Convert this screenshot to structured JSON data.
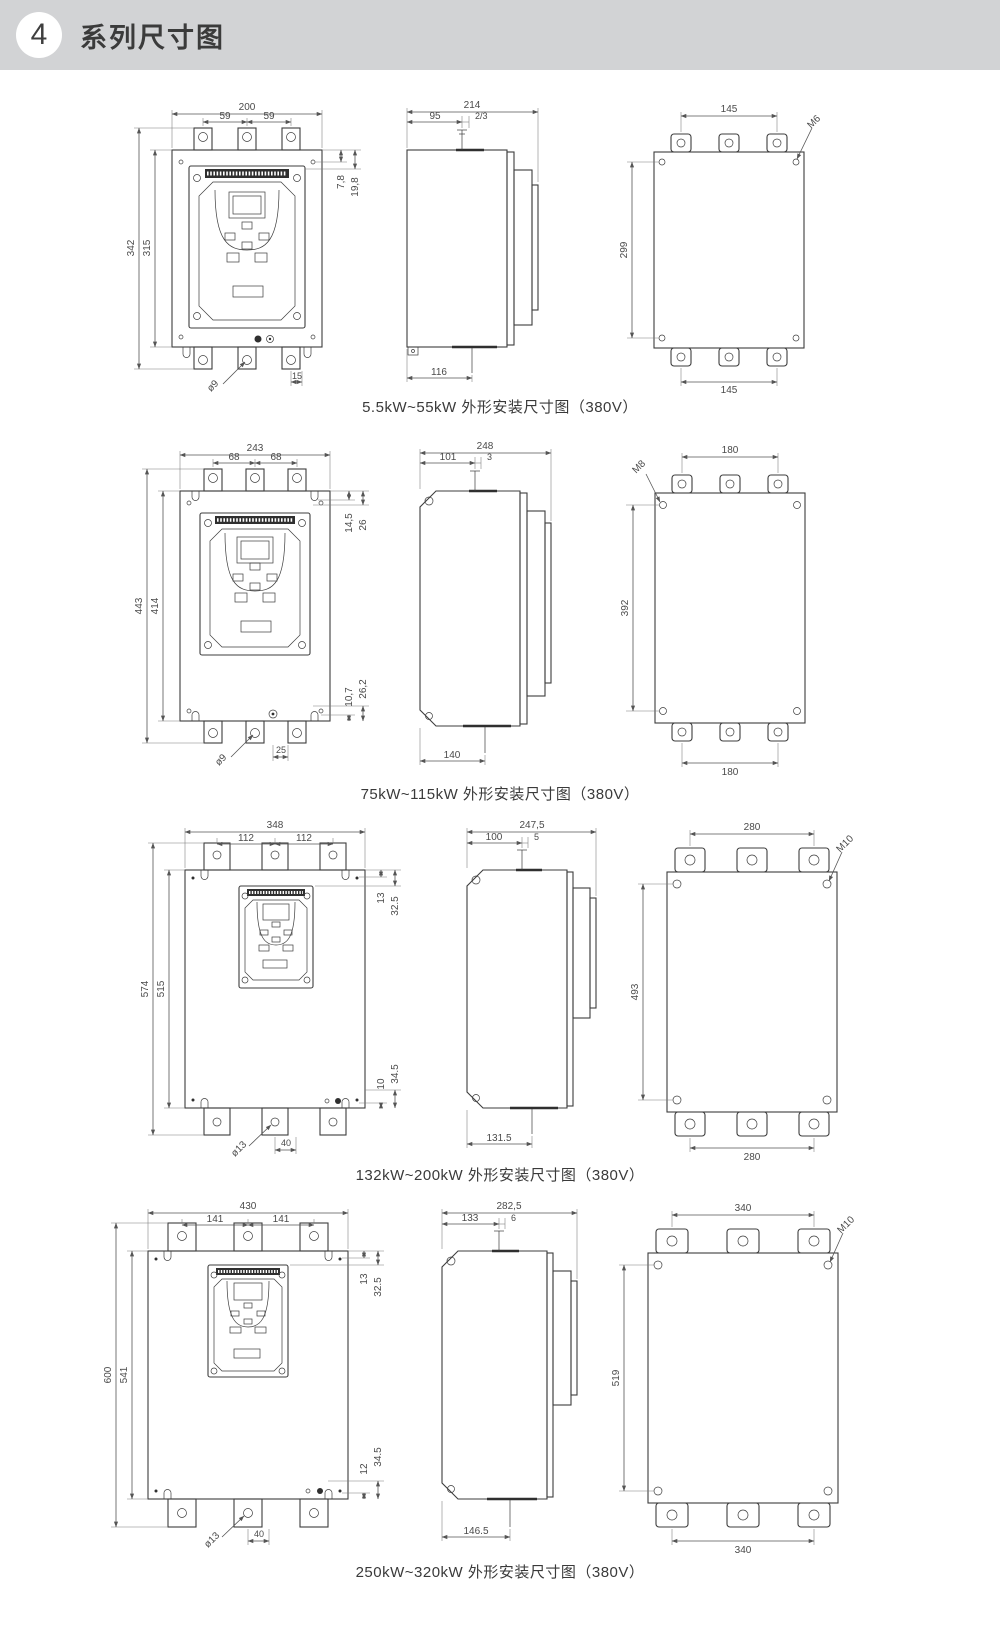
{
  "header": {
    "badge": "4",
    "title": "系列尺寸图"
  },
  "sections": [
    {
      "caption": "5.5kW~55kW 外形安装尺寸图（380V）",
      "front": {
        "overall_width": "200",
        "hole_pitch_left": "59",
        "hole_pitch_right": "59",
        "overall_height": "342",
        "body_height": "315",
        "top_offset_a": "7,8",
        "top_offset_b": "19,8",
        "mount_hole_dia": "ø9",
        "bottom_pitch": "15"
      },
      "side": {
        "overall_depth": "214",
        "front_depth": "95",
        "tab_dim": "2/3",
        "base_depth": "116"
      },
      "back": {
        "hole_pitch_top": "145",
        "screw_size": "M6",
        "hole_pitch_vertical": "299",
        "hole_pitch_bottom": "145"
      }
    },
    {
      "caption": "75kW~115kW 外形安装尺寸图（380V）",
      "front": {
        "overall_width": "243",
        "hole_pitch_left": "68",
        "hole_pitch_right": "68",
        "overall_height": "443",
        "body_height": "414",
        "top_offset_a": "14,5",
        "top_offset_b": "26",
        "bottom_offset_a": "10,7",
        "bottom_offset_b": "26,2",
        "mount_hole_dia": "ø9",
        "bottom_pitch": "25"
      },
      "side": {
        "overall_depth": "248",
        "front_depth": "101",
        "tab_dim": "3",
        "base_depth": "140"
      },
      "back": {
        "hole_pitch_top": "180",
        "screw_size": "M8",
        "hole_pitch_vertical": "392",
        "hole_pitch_bottom": "180"
      }
    },
    {
      "caption": "132kW~200kW 外形安装尺寸图（380V）",
      "front": {
        "overall_width": "348",
        "hole_pitch_left": "112",
        "hole_pitch_right": "112",
        "overall_height": "574",
        "body_height": "515",
        "top_offset_a": "13",
        "top_offset_b": "32.5",
        "bottom_offset_a": "10",
        "bottom_offset_b": "34.5",
        "mount_hole_dia": "ø13",
        "bottom_pitch": "40"
      },
      "side": {
        "overall_depth": "247,5",
        "front_depth": "100",
        "tab_dim": "5",
        "base_depth": "131.5"
      },
      "back": {
        "hole_pitch_top": "280",
        "screw_size": "M10",
        "hole_pitch_vertical": "493",
        "hole_pitch_bottom": "280"
      }
    },
    {
      "caption": "250kW~320kW 外形安装尺寸图（380V）",
      "front": {
        "overall_width": "430",
        "hole_pitch_left": "141",
        "hole_pitch_right": "141",
        "overall_height": "600",
        "body_height": "541",
        "top_offset_a": "13",
        "top_offset_b": "32.5",
        "bottom_offset_a": "12",
        "bottom_offset_b": "34.5",
        "mount_hole_dia": "ø13",
        "bottom_pitch": "40"
      },
      "side": {
        "overall_depth": "282,5",
        "front_depth": "133",
        "tab_dim": "6",
        "base_depth": "146.5"
      },
      "back": {
        "hole_pitch_top": "340",
        "screw_size": "M10",
        "hole_pitch_vertical": "519",
        "hole_pitch_bottom": "340"
      }
    }
  ]
}
